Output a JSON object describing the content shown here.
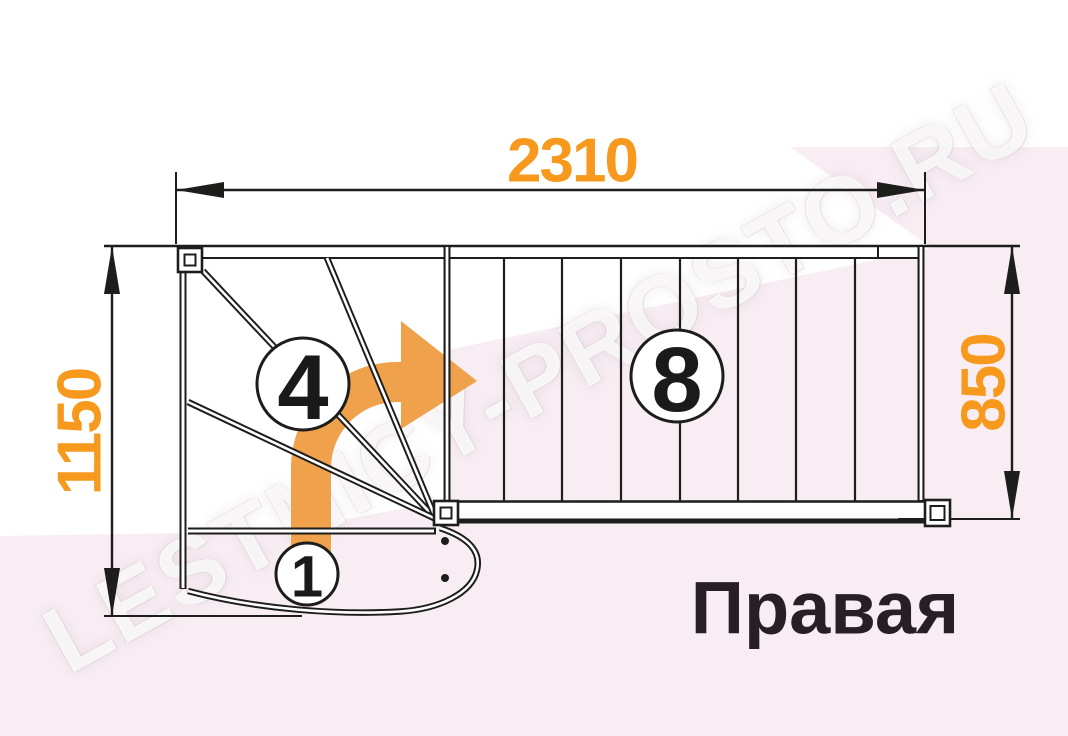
{
  "watermark": {
    "text": "LESTNICY-PROSTO.RU"
  },
  "plan": {
    "direction_label": "Правая",
    "dimensions": {
      "total_run": "2310",
      "total_width": "1150",
      "flight_width": "850"
    },
    "step_numbers": {
      "winder": "4",
      "straight_flight": "8",
      "starting_step": "1"
    }
  },
  "colors": {
    "dimension_text": "#f6991c",
    "turn_arrow": "#efa14b",
    "linework": "#1d1d1b",
    "background_pink": "#f7edf3",
    "background_white": "#ffffff",
    "direction_text": "#262026"
  }
}
